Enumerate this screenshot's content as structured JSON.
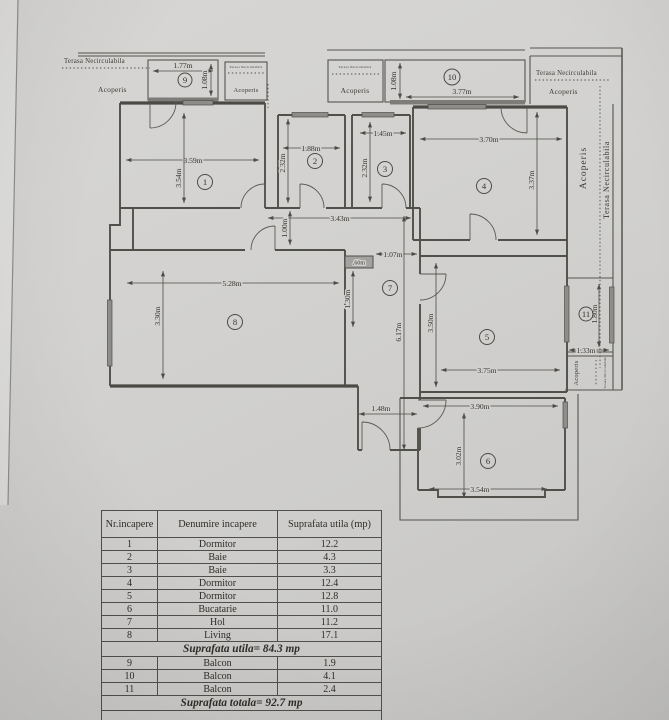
{
  "plan": {
    "labels": {
      "terasa": "Terasa Necirculabila",
      "acoperis": "Acoperis"
    },
    "room_numbers": [
      "1",
      "2",
      "3",
      "4",
      "5",
      "6",
      "7",
      "8",
      "9",
      "10",
      "11"
    ],
    "dims": {
      "r1w": "3.59m",
      "r1h": "3.54m",
      "r2w": "1.88m",
      "r2h": "2.32m",
      "r3w": "1.45m",
      "r3h": "2.32m",
      "r4w": "3.70m",
      "r4h": "3.37m",
      "r5w": "3.75m",
      "r5h": "3.50m",
      "r6w_top": "3.90m",
      "r6h": "3.02m",
      "r6w_bottom": "3.54m",
      "r8w": "5.28m",
      "r8h": "3.30m",
      "r9w": "1.77m",
      "r9h": "1.08m",
      "r10w": "3.77m",
      "r10h": "1.08m",
      "r11w": "1.33m",
      "r11h": "1.80m",
      "corridor_w": "3.43m",
      "corridor_h": "1.00m",
      "hall_w": "1.07m",
      "hall_h": "6.17m",
      "niche_w": ".60m",
      "niche_h": "1.30m",
      "entrance_w": "1.48m"
    }
  },
  "table": {
    "headers": [
      "Nr.incapere",
      "Denumire incapere",
      "Suprafata utila (mp)"
    ],
    "rows": [
      [
        "1",
        "Dormitor",
        "12.2"
      ],
      [
        "2",
        "Baie",
        "4.3"
      ],
      [
        "3",
        "Baie",
        "3.3"
      ],
      [
        "4",
        "Dormitor",
        "12.4"
      ],
      [
        "5",
        "Dormitor",
        "12.8"
      ],
      [
        "6",
        "Bucatarie",
        "11.0"
      ],
      [
        "7",
        "Hol",
        "11.2"
      ],
      [
        "8",
        "Living",
        "17.1"
      ]
    ],
    "subtotal": "Suprafata utila= 84.3 mp",
    "rows2": [
      [
        "9",
        "Balcon",
        "1.9"
      ],
      [
        "10",
        "Balcon",
        "4.1"
      ],
      [
        "11",
        "Balcon",
        "2.4"
      ]
    ],
    "total": "Suprafata totala= 92.7 mp"
  }
}
